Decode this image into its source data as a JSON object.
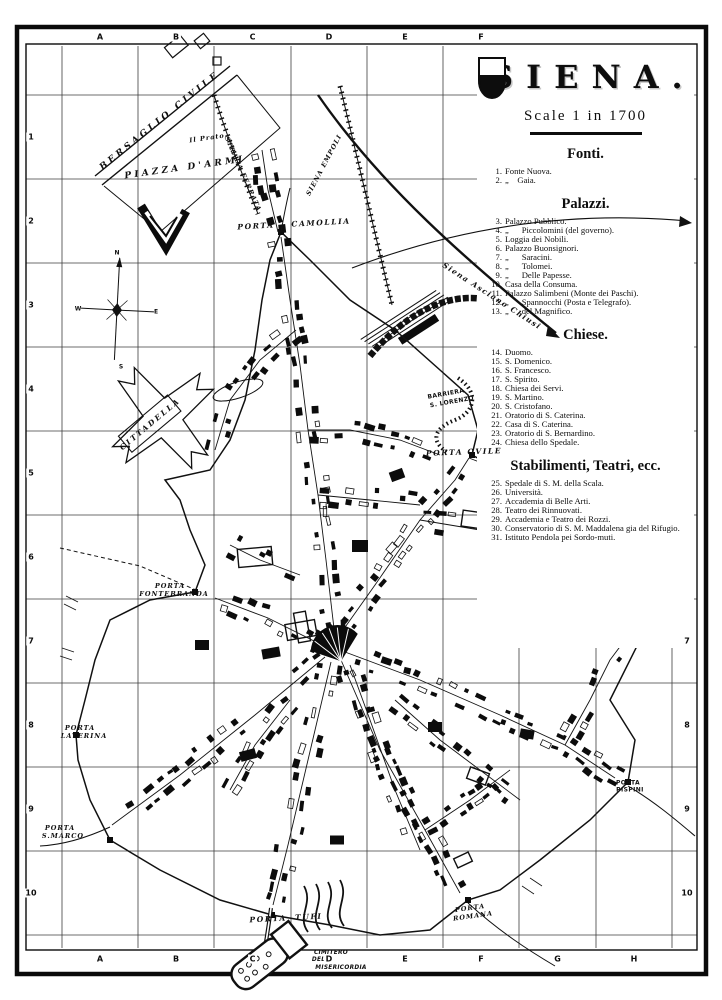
{
  "title_block": {
    "title": "SIENA.",
    "scale_label": "Scale 1 in 1700"
  },
  "legend": {
    "sections": [
      {
        "heading": "Fonti.",
        "items": [
          {
            "n": "1.",
            "t": "Fonte Nuova."
          },
          {
            "n": "2.",
            "t": "„    Gaia."
          }
        ]
      },
      {
        "heading": "Palazzi.",
        "items": [
          {
            "n": "3.",
            "t": "Palazzo Pubblico."
          },
          {
            "n": "4.",
            "t": "„      Piccolomini (del governo)."
          },
          {
            "n": "5.",
            "t": "Loggia dei Nobili."
          },
          {
            "n": "6.",
            "t": "Palazzo Buonsignori."
          },
          {
            "n": "7.",
            "t": "„      Saracini."
          },
          {
            "n": "8.",
            "t": "„      Tolomei."
          },
          {
            "n": "9.",
            "t": "„      Delle Papesse."
          },
          {
            "n": "10.",
            "t": "Casa della Consuma."
          },
          {
            "n": "11.",
            "t": "Palazzo Salimbeni (Monte dei Paschi)."
          },
          {
            "n": "12.",
            "t": "„      Spannocchi (Posta e Telegrafo)."
          },
          {
            "n": "13.",
            "t": "„      del Magnifico."
          }
        ]
      },
      {
        "heading": "Chiese.",
        "items": [
          {
            "n": "14.",
            "t": "Duomo."
          },
          {
            "n": "15.",
            "t": "S. Domenico."
          },
          {
            "n": "16.",
            "t": "S. Francesco."
          },
          {
            "n": "17.",
            "t": "S. Spirito."
          },
          {
            "n": "18.",
            "t": "Chiesa dei Servi."
          },
          {
            "n": "19.",
            "t": "S. Martino."
          },
          {
            "n": "20.",
            "t": "S. Cristofano."
          },
          {
            "n": "21.",
            "t": "Oratorio di S. Caterina."
          },
          {
            "n": "22.",
            "t": "Casa di S. Caterina."
          },
          {
            "n": "23.",
            "t": "Oratorio di S. Bernardino."
          },
          {
            "n": "24.",
            "t": "Chiesa dello Spedale."
          }
        ]
      },
      {
        "heading": "Stabilimenti, Teatri, ecc.",
        "items": [
          {
            "n": "25.",
            "t": "Spedale di S. M. della Scala."
          },
          {
            "n": "26.",
            "t": "Università."
          },
          {
            "n": "27.",
            "t": "Accademia di Belle Arti."
          },
          {
            "n": "28.",
            "t": "Teatro dei Rinnuovati."
          },
          {
            "n": "29.",
            "t": "Accademia e Teatro dei Rozzi."
          },
          {
            "n": "30.",
            "t": "Conservatorio di S. M. Maddalena gia del Rifugio."
          },
          {
            "n": "31.",
            "t": "Istituto Pendola pei Sordo-muti."
          }
        ]
      }
    ]
  },
  "grid": {
    "top_letters": [
      "A",
      "B",
      "C",
      "D",
      "E",
      "F"
    ],
    "bottom_letters": [
      "A",
      "B",
      "C",
      "D",
      "E",
      "F",
      "G",
      "H"
    ],
    "left_numbers": [
      "1",
      "2",
      "3",
      "4",
      "5",
      "6",
      "7",
      "8",
      "9",
      "10"
    ],
    "right_numbers": [
      "7",
      "8",
      "9",
      "10"
    ]
  },
  "map_labels": [
    {
      "text": "BERSAGLIO CIVILE",
      "x": 160,
      "y": 121,
      "rot": -39,
      "cls": "lbl-spaced"
    },
    {
      "text": "PIAZZA D'ARMI",
      "x": 185,
      "y": 168,
      "rot": -8,
      "cls": "lbl-spaced"
    },
    {
      "text": "Il Prato",
      "x": 207,
      "y": 138,
      "rot": -8,
      "cls": "lbl-tiny"
    },
    {
      "text": "STRADA FERRATA",
      "x": 243,
      "y": 174,
      "rot": 66,
      "cls": "lbl-tiny"
    },
    {
      "text": "SIENA EMPOLI",
      "x": 324,
      "y": 165,
      "rot": -62,
      "cls": "lbl-tiny"
    },
    {
      "text": "PORTA    CAMOLLIA",
      "x": 294,
      "y": 224,
      "rot": -3,
      "cls": "lbl-porta"
    },
    {
      "text": "Siena Asciano Chiusi",
      "x": 492,
      "y": 296,
      "rot": 33,
      "cls": "lbl-rail"
    },
    {
      "text": "CITTADELLA",
      "x": 150,
      "y": 424,
      "rot": -40,
      "cls": "lbl-cittadella"
    },
    {
      "text": "BARRIERA",
      "x": 446,
      "y": 394,
      "rot": -10,
      "cls": "lbl-micro"
    },
    {
      "text": "S. LORENZO",
      "x": 452,
      "y": 402,
      "rot": -10,
      "cls": "lbl-micro"
    },
    {
      "text": "PORTA OVILE",
      "x": 464,
      "y": 452,
      "rot": -2,
      "cls": "lbl-porta"
    },
    {
      "text": "PORTA",
      "x": 170,
      "y": 586,
      "rot": 0,
      "cls": "lbl-porta-sm"
    },
    {
      "text": "FONTEBRANDA",
      "x": 174,
      "y": 594,
      "rot": 0,
      "cls": "lbl-porta-sm"
    },
    {
      "text": "PORTA",
      "x": 80,
      "y": 728,
      "rot": 0,
      "cls": "lbl-porta-sm"
    },
    {
      "text": "LATERINA",
      "x": 84,
      "y": 736,
      "rot": 0,
      "cls": "lbl-porta-sm"
    },
    {
      "text": "PORTA",
      "x": 60,
      "y": 828,
      "rot": 0,
      "cls": "lbl-porta-sm"
    },
    {
      "text": "S.MARCO",
      "x": 63,
      "y": 836,
      "rot": 0,
      "cls": "lbl-porta-sm"
    },
    {
      "text": "PORTA  TUFI",
      "x": 286,
      "y": 918,
      "rot": -3,
      "cls": "lbl-porta"
    },
    {
      "text": "PORTA",
      "x": 470,
      "y": 908,
      "rot": -8,
      "cls": "lbl-porta-sm"
    },
    {
      "text": "ROMANA",
      "x": 473,
      "y": 916,
      "rot": -8,
      "cls": "lbl-porta-sm"
    },
    {
      "text": "PORTA",
      "x": 628,
      "y": 783,
      "rot": 0,
      "cls": "lbl-micro"
    },
    {
      "text": "PISPINI",
      "x": 630,
      "y": 790,
      "rot": 0,
      "cls": "lbl-micro"
    },
    {
      "text": "CIMITERO",
      "x": 331,
      "y": 953,
      "rot": 0,
      "cls": "lbl-cimitero"
    },
    {
      "text": "DELLA",
      "x": 323,
      "y": 960,
      "rot": 0,
      "cls": "lbl-cimitero"
    },
    {
      "text": "MISERICORDIA",
      "x": 341,
      "y": 968,
      "rot": 0,
      "cls": "lbl-cimitero"
    },
    {
      "text": "N",
      "x": 117,
      "y": 253,
      "rot": 0,
      "cls": "lbl-compass"
    },
    {
      "text": "W",
      "x": 78,
      "y": 309,
      "rot": 0,
      "cls": "lbl-compass"
    },
    {
      "text": "E",
      "x": 156,
      "y": 312,
      "rot": 0,
      "cls": "lbl-compass"
    },
    {
      "text": "S",
      "x": 121,
      "y": 367,
      "rot": 0,
      "cls": "lbl-compass"
    }
  ]
}
